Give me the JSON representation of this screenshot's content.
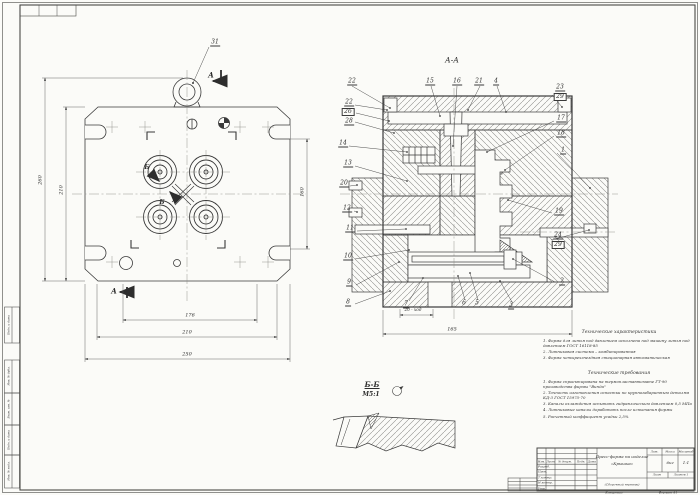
{
  "plan": {
    "callout_ring": "31",
    "section_letter": "А",
    "detail_letter": "Б",
    "dims": {
      "left_outer": "260",
      "left_inner": "210",
      "right": "160",
      "bottom1": "176",
      "bottom2": "210",
      "bottom3": "250"
    }
  },
  "section": {
    "title": "А-А",
    "callouts": {
      "top": [
        "22",
        "15",
        "16",
        "21",
        "4"
      ],
      "right": [
        "23",
        "29",
        "17",
        "18",
        "1",
        "19",
        "24",
        "29",
        "2"
      ],
      "left": [
        "22",
        "26",
        "28",
        "14",
        "13",
        "20",
        "12",
        "11",
        "10",
        "9",
        "8"
      ],
      "bottom": [
        "7",
        "6",
        "5",
        "3"
      ]
    },
    "dims": {
      "stroke": "20 - ход",
      "width": "165"
    }
  },
  "detail": {
    "title": "Б-Б",
    "scale": "М5:1"
  },
  "tech_char": {
    "title": "Технические характеристики",
    "items": [
      "1. Форма для литья под давлением исполнена под машину литья под давлением ГОСТ 16118-85",
      "2. Литниковая система – комбинированная",
      "3. Форма четырехгнездная стационарная автоматическая"
    ]
  },
  "tech_req": {
    "title": "Технические требования",
    "items": [
      "1. Форма спроектирована на термопластавтомате ГТ-90 производства фирмы \"Винда\"",
      "2. Точность изготовления оснастки по крупногабаритным деталям КД-3 ГОСТ 15975-70",
      "3. Каналы охлаждения испытать гидравлическим давлением 0,5 МПа",
      "4. Литниковые каналы доработать после испытания формы",
      "5. Расчетный коэффициент усадки 2,5%"
    ]
  },
  "title_block": {
    "title_line1": "Пресс-форма на изделие",
    "title_line2": "«Крышка»",
    "subtitle": "(Сборочный чертеж)",
    "headers": {
      "izm": "Изм.",
      "list": "Лист",
      "doc": "№ докум.",
      "sign": "Подп.",
      "date": "Дата",
      "lit": "Лит.",
      "mass": "Масса",
      "scale": "Масштаб",
      "sheet": "Лист",
      "sheets": "Листов 1"
    },
    "values": {
      "mass": "6кг",
      "scale": "1:1"
    },
    "roles": [
      "Разраб.",
      "Пров.",
      "Т.контр.",
      "Н.контр.",
      "Утв."
    ]
  },
  "margin": {
    "copied": "Копировал",
    "format": "Формат А1"
  },
  "side_stamp": {
    "labels": [
      "Подп. и дата",
      "Инв. № дубл.",
      "Взам. инв. №",
      "Подп. и дата",
      "Инв. № подл."
    ]
  }
}
